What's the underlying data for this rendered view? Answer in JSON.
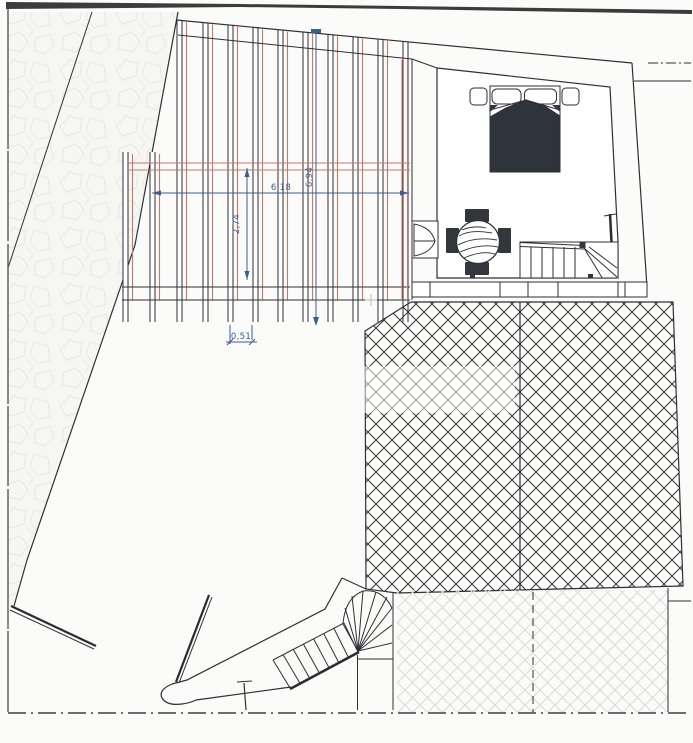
{
  "drawing": {
    "type": "architectural-roof-terrace-plan",
    "dimension_labels": {
      "width_total": "6,18",
      "height_total": "6,94",
      "height_partial": "2,74",
      "joist_spacing": "0,51"
    },
    "colors": {
      "ink": "#2f2f37",
      "rafter_orange": "#c5796a",
      "dimension_blue": "#3c5d92",
      "paper": "#fbfbf9",
      "blanket_dark": "#2f333c",
      "tile_line": "#3a3a42",
      "faint_tile_line": "#d9dbd4"
    }
  }
}
